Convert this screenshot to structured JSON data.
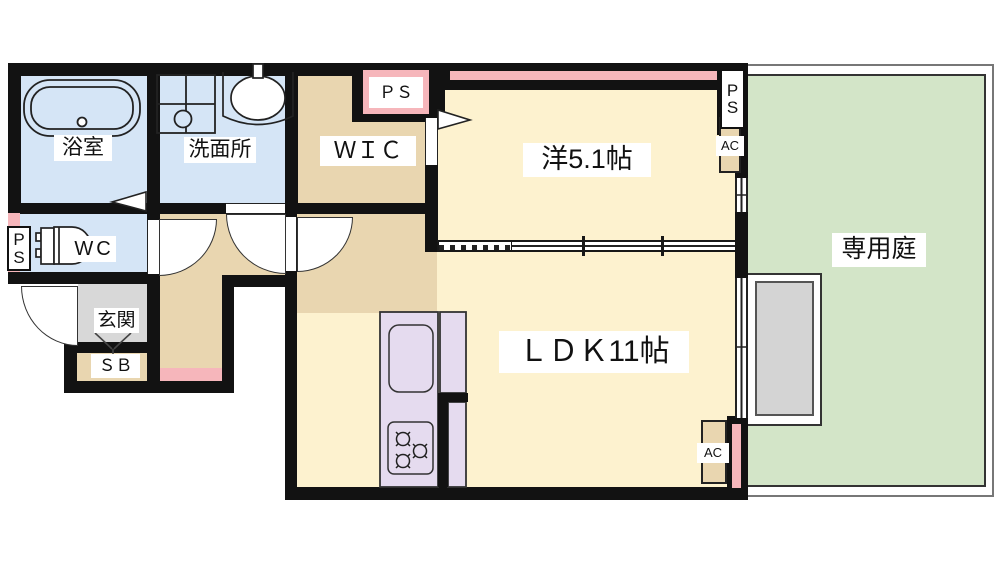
{
  "title": "apartment-floor-plan",
  "rooms": {
    "bathroom": {
      "label": "浴室"
    },
    "washroom": {
      "label": "洗面所"
    },
    "toilet": {
      "label": "WC"
    },
    "wic": {
      "label": "ＷＩＣ"
    },
    "western_room": {
      "label": "洋5.1帖",
      "size_tatami": 5.1
    },
    "ldk": {
      "label": "ＬＤＫ11帖",
      "size_tatami": 11
    },
    "entrance": {
      "label": "玄関"
    },
    "shoe_box": {
      "label": "ＳＢ"
    },
    "garden": {
      "label": "専用庭"
    }
  },
  "annotations": {
    "ps_left": "P\nS",
    "ps_top": "ＰＳ",
    "ps_right": "P\nS",
    "ac_bedroom": "AC",
    "ac_ldk": "AC"
  },
  "colors": {
    "wall": "#121212",
    "water_blue": "#d5e5f6",
    "room_cream": "#fdf2cf",
    "hall_tan": "#e9d6b0",
    "kitchen_lavender": "#e5dbef",
    "entrance_gray": "#d8d8d8",
    "garden_green": "#d3e5c8",
    "shared_wall_pink": "#f6b6bb",
    "terrace_gray": "#d4d4d4"
  }
}
